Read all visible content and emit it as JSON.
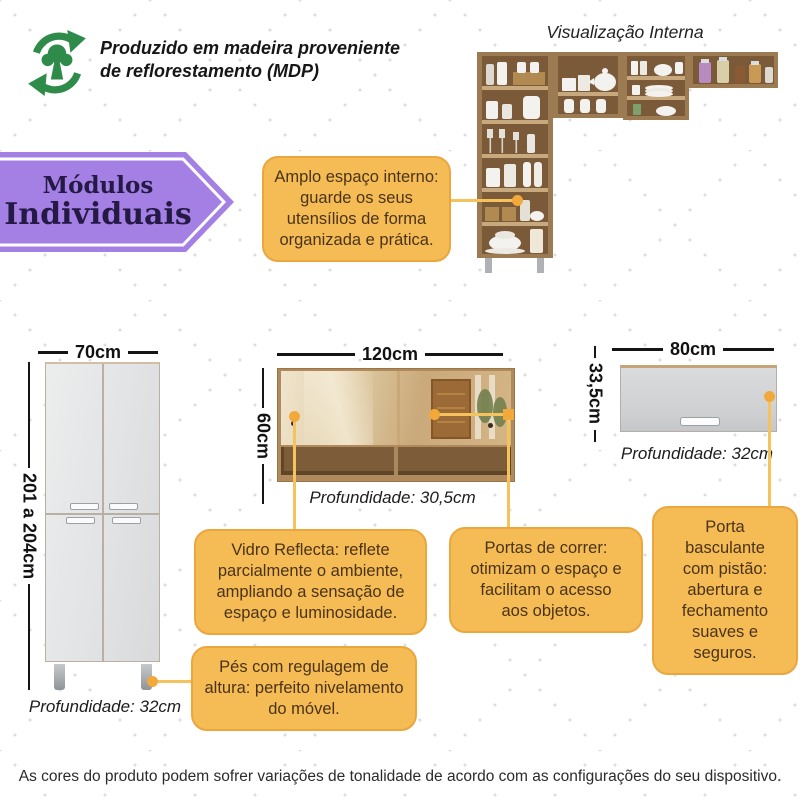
{
  "colors": {
    "accent_orange": "#F5BB55",
    "accent_orange_border": "#ECA63E",
    "connector_orange": "#F2A93B",
    "banner_purple": "#A480E4",
    "eco_green": "#2E8B49",
    "wood": "#9C7B52",
    "cabinet_gray": "#E7E8EA"
  },
  "eco": {
    "text": "Produzido em madeira proveniente\nde reflorestamento (MDP)"
  },
  "internal_view": {
    "title": "Visualização Interna"
  },
  "banner": {
    "line1": "Módulos",
    "line2": "Individuais"
  },
  "modules": {
    "tall": {
      "width": "70cm",
      "height": "201 a 204cm",
      "depth": "Profundidade: 32cm"
    },
    "sliding": {
      "width": "120cm",
      "height": "60cm",
      "depth": "Profundidade: 30,5cm"
    },
    "flip": {
      "width": "80cm",
      "height": "33,5cm",
      "depth": "Profundidade: 32cm"
    }
  },
  "callouts": {
    "amplo_espaco": "Amplo espaço interno:\nguarde os seus\nutensílios de forma\norganizada e prática.",
    "vidro_reflecta": "Vidro Reflecta: reflete\nparcialmente o ambiente,\nampliando a sensação de\nespaço e luminosidade.",
    "portas_correr": "Portas de correr:\notimizam o espaço e\nfacilitam o acesso\naos objetos.",
    "porta_basculante": "Porta basculante\ncom pistão:\nabertura e\nfechamento\nsuaves e seguros.",
    "pes_regulagem": "Pés com regulagem de\naltura: perfeito nivelamento\ndo móvel."
  },
  "footer": {
    "disclaimer": "As cores do produto podem sofrer variações de tonalidade de acordo com as configurações do seu dispositivo."
  }
}
